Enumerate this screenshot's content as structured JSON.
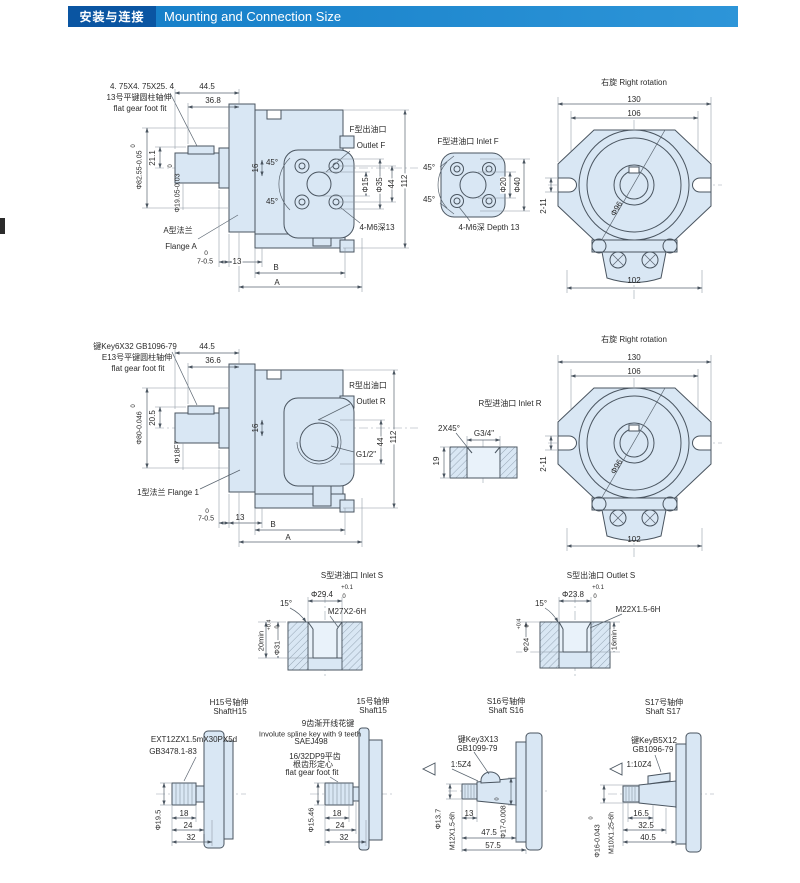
{
  "header": {
    "title_cn": "安装与连接",
    "title_en": "Mounting and Connection Size"
  },
  "colors": {
    "header_box": "#0a55a2",
    "header_bar_from": "#1780c9",
    "header_bar_to": "#2d95d8",
    "draw_fill": "#d9e7f4",
    "line": "#4a5560"
  },
  "labels": [
    {
      "n": "a-key-size",
      "t": "4. 75X4. 75X25. 4",
      "x": 142,
      "y": 87
    },
    {
      "n": "a-key-note-cn",
      "t": "13号平键圆柱轴伸",
      "x": 139,
      "y": 98
    },
    {
      "n": "a-key-note-en",
      "t": "flat gear foot fit",
      "x": 140,
      "y": 109
    },
    {
      "n": "a-dim-44-5",
      "t": "44.5",
      "x": 207,
      "y": 87
    },
    {
      "n": "a-dim-36-8",
      "t": "36.8",
      "x": 213,
      "y": 101
    },
    {
      "n": "a-dim-21-1",
      "t": "21.1",
      "x": 153,
      "y": 158,
      "r": -90
    },
    {
      "n": "a-dim-d82-55",
      "t": "Φ82.55-0.05",
      "x": 140,
      "y": 170,
      "r": -90,
      "s": 7
    },
    {
      "n": "a-dim-d82-55-sup",
      "t": "0",
      "x": 134,
      "y": 146,
      "r": -90,
      "s": 6
    },
    {
      "n": "a-dim-d19-05",
      "t": "Φ19.05-0.03",
      "x": 178,
      "y": 193,
      "r": -90,
      "s": 7
    },
    {
      "n": "a-dim-d19-05-sup",
      "t": "0",
      "x": 171,
      "y": 166,
      "r": -90,
      "s": 6
    },
    {
      "n": "a-dim-16",
      "t": "16",
      "x": 256,
      "y": 168,
      "r": -90
    },
    {
      "n": "a-angle-45-top",
      "t": "45°",
      "x": 272,
      "y": 163
    },
    {
      "n": "a-angle-45-bot",
      "t": "45°",
      "x": 272,
      "y": 202
    },
    {
      "n": "outlet-f-cn",
      "t": "F型出油口",
      "x": 368,
      "y": 130
    },
    {
      "n": "outlet-f-en",
      "t": "Outlet F",
      "x": 371,
      "y": 146
    },
    {
      "n": "a-dim-d15",
      "t": "Φ15",
      "x": 366,
      "y": 185,
      "r": -90,
      "b": 1
    },
    {
      "n": "a-dim-d35",
      "t": "Φ35",
      "x": 380,
      "y": 185,
      "r": -90,
      "b": 1
    },
    {
      "n": "a-dim-44",
      "t": "44",
      "x": 392,
      "y": 184,
      "r": -90,
      "b": 1
    },
    {
      "n": "a-dim-112",
      "t": "112",
      "x": 405,
      "y": 181,
      "r": -90,
      "b": 1
    },
    {
      "n": "a-m6-note",
      "t": "4-M6深13",
      "x": 377,
      "y": 228
    },
    {
      "n": "flange-a-cn",
      "t": "A型法兰",
      "x": 178,
      "y": 231
    },
    {
      "n": "flange-a-en",
      "t": "Flange A",
      "x": 181,
      "y": 247
    },
    {
      "n": "a-dim-7-sup",
      "t": "0",
      "x": 206,
      "y": 254,
      "s": 6.5
    },
    {
      "n": "a-dim-7",
      "t": "7-0.5",
      "x": 205,
      "y": 262,
      "s": 7
    },
    {
      "n": "a-dim-13",
      "t": "13",
      "x": 237,
      "y": 262,
      "b": 1
    },
    {
      "n": "a-dim-b",
      "t": "B",
      "x": 276,
      "y": 268
    },
    {
      "n": "a-dim-a",
      "t": "A",
      "x": 277,
      "y": 283
    },
    {
      "n": "inlet-f-title",
      "t": "F型进油口  Inlet F",
      "x": 468,
      "y": 142
    },
    {
      "n": "f-angle-45-top",
      "t": "45°",
      "x": 429,
      "y": 168
    },
    {
      "n": "f-angle-45-bot",
      "t": "45°",
      "x": 429,
      "y": 200
    },
    {
      "n": "f-dim-d20",
      "t": "Φ20",
      "x": 504,
      "y": 185,
      "r": -90,
      "b": 1
    },
    {
      "n": "f-dim-d40",
      "t": "Φ40",
      "x": 518,
      "y": 185,
      "r": -90,
      "b": 1
    },
    {
      "n": "f-m6-note",
      "t": "4-M6深  Depth 13",
      "x": 489,
      "y": 228
    },
    {
      "n": "rot1-title",
      "t": "右旋  Right rotation",
      "x": 634,
      "y": 83
    },
    {
      "n": "rot1-dim-130",
      "t": "130",
      "x": 634,
      "y": 100
    },
    {
      "n": "rot1-dim-106",
      "t": "106",
      "x": 634,
      "y": 114
    },
    {
      "n": "rot1-dim-2-11",
      "t": "2-11",
      "x": 544,
      "y": 206,
      "r": -90
    },
    {
      "n": "rot1-dim-d96",
      "t": "Φ96",
      "x": 617,
      "y": 209,
      "r": -60
    },
    {
      "n": "rot1-dim-102",
      "t": "102",
      "x": 634,
      "y": 281
    },
    {
      "n": "r-key-note",
      "t": "键Key6X32  GB1096-79",
      "x": 135,
      "y": 347
    },
    {
      "n": "r-key-note-cn",
      "t": "E13号平键圆柱轴伸",
      "x": 137,
      "y": 358
    },
    {
      "n": "r-key-note-en",
      "t": "flat gear foot fit",
      "x": 138,
      "y": 369
    },
    {
      "n": "r-dim-44-5",
      "t": "44.5",
      "x": 207,
      "y": 347
    },
    {
      "n": "r-dim-36-6",
      "t": "36.6",
      "x": 213,
      "y": 361
    },
    {
      "n": "r-dim-20-5",
      "t": "20.5",
      "x": 153,
      "y": 418,
      "r": -90
    },
    {
      "n": "r-dim-d80",
      "t": "Φ80-0.046",
      "x": 140,
      "y": 428,
      "r": -90,
      "s": 7
    },
    {
      "n": "r-dim-d80-sup",
      "t": "0",
      "x": 134,
      "y": 406,
      "r": -90,
      "s": 6
    },
    {
      "n": "r-dim-d18f7",
      "t": "Φ18F7",
      "x": 177,
      "y": 452,
      "r": -90,
      "s": 7.5
    },
    {
      "n": "r-dim-16",
      "t": "16",
      "x": 256,
      "y": 428,
      "r": -90
    },
    {
      "n": "outlet-r-cn",
      "t": "R型出油口",
      "x": 368,
      "y": 386
    },
    {
      "n": "outlet-r-en",
      "t": "Outlet R",
      "x": 371,
      "y": 402
    },
    {
      "n": "r-g12",
      "t": "G1/2\"",
      "x": 366,
      "y": 455
    },
    {
      "n": "r-dim-44",
      "t": "44",
      "x": 381,
      "y": 442,
      "r": -90,
      "b": 1
    },
    {
      "n": "r-dim-112",
      "t": "112",
      "x": 394,
      "y": 437,
      "r": -90,
      "b": 1
    },
    {
      "n": "flange-1",
      "t": "1型法兰  Flange 1",
      "x": 168,
      "y": 493
    },
    {
      "n": "r-dim-7-sup",
      "t": "0",
      "x": 207,
      "y": 512,
      "s": 6.5
    },
    {
      "n": "r-dim-7",
      "t": "7-0.5",
      "x": 206,
      "y": 519,
      "s": 7
    },
    {
      "n": "r-dim-13",
      "t": "13",
      "x": 240,
      "y": 518
    },
    {
      "n": "r-dim-b",
      "t": "B",
      "x": 273,
      "y": 525
    },
    {
      "n": "r-dim-a",
      "t": "A",
      "x": 288,
      "y": 538
    },
    {
      "n": "inlet-r-title",
      "t": "R型进油口  Inlet R",
      "x": 510,
      "y": 404
    },
    {
      "n": "r-2x45",
      "t": "2X45°",
      "x": 449,
      "y": 429
    },
    {
      "n": "r-g34",
      "t": "G3/4\"",
      "x": 484,
      "y": 434
    },
    {
      "n": "r-dim-19",
      "t": "19",
      "x": 437,
      "y": 461,
      "r": -90
    },
    {
      "n": "rot2-title",
      "t": "右旋  Right rotation",
      "x": 634,
      "y": 340
    },
    {
      "n": "rot2-dim-130",
      "t": "130",
      "x": 634,
      "y": 358
    },
    {
      "n": "rot2-dim-106",
      "t": "106",
      "x": 634,
      "y": 372
    },
    {
      "n": "rot2-dim-2-11",
      "t": "2-11",
      "x": 544,
      "y": 464,
      "r": -90
    },
    {
      "n": "rot2-dim-d96",
      "t": "Φ96",
      "x": 617,
      "y": 467,
      "r": -60
    },
    {
      "n": "rot2-dim-102",
      "t": "102",
      "x": 634,
      "y": 540
    },
    {
      "n": "inlet-s-title",
      "t": "S型进油口  Inlet S",
      "x": 352,
      "y": 576
    },
    {
      "n": "s-dim-d29-4",
      "t": "Φ29.4",
      "x": 322,
      "y": 595
    },
    {
      "n": "s-dim-d29-4-sup",
      "t": "+0.1",
      "x": 347,
      "y": 588,
      "s": 6
    },
    {
      "n": "s-dim-d29-4-sub",
      "t": "0",
      "x": 344,
      "y": 597,
      "s": 6
    },
    {
      "n": "s-angle-15",
      "t": "15°",
      "x": 286,
      "y": 604
    },
    {
      "n": "s-thread-m27",
      "t": "M27X2-6H",
      "x": 347,
      "y": 612
    },
    {
      "n": "s-dim-20min",
      "t": "20min",
      "x": 261,
      "y": 641,
      "r": -90,
      "s": 7.5
    },
    {
      "n": "s-dim-d31",
      "t": "Φ31",
      "x": 277,
      "y": 648,
      "r": -90,
      "s": 7.5,
      "b": 1
    },
    {
      "n": "s-dim-d31-sup",
      "t": "+0.4",
      "x": 270,
      "y": 625,
      "r": -90,
      "s": 5.5
    },
    {
      "n": "s-dim-d31-sub",
      "t": "0",
      "x": 278,
      "y": 627,
      "r": -90,
      "s": 5.5
    },
    {
      "n": "outlet-s-title",
      "t": "S型出油口  Outlet S",
      "x": 601,
      "y": 576
    },
    {
      "n": "s-dim-d23-8",
      "t": "Φ23.8",
      "x": 573,
      "y": 595
    },
    {
      "n": "s-dim-d23-8-sup",
      "t": "+0.1",
      "x": 598,
      "y": 588,
      "s": 6
    },
    {
      "n": "s-dim-d23-8-sub",
      "t": "0",
      "x": 595,
      "y": 597,
      "s": 6
    },
    {
      "n": "so-angle-15",
      "t": "15°",
      "x": 541,
      "y": 604
    },
    {
      "n": "s-thread-m22",
      "t": "M22X1.5-6H",
      "x": 638,
      "y": 610
    },
    {
      "n": "s-dim-d24",
      "t": "Φ24",
      "x": 526,
      "y": 645,
      "r": -90,
      "s": 7.5,
      "b": 1
    },
    {
      "n": "s-dim-d24-sup",
      "t": "+0.4",
      "x": 520,
      "y": 624,
      "r": -90,
      "s": 5.5
    },
    {
      "n": "s-dim-d24-sub",
      "t": "0",
      "x": 528,
      "y": 626,
      "r": -90,
      "s": 5.5
    },
    {
      "n": "s-dim-16min",
      "t": "16min",
      "x": 614,
      "y": 640,
      "r": -90,
      "s": 7.5,
      "b": 1
    },
    {
      "n": "sh1-title-cn",
      "t": "H15号轴伸",
      "x": 229,
      "y": 703
    },
    {
      "n": "sh1-title-en",
      "t": "ShaftH15",
      "x": 230,
      "y": 712
    },
    {
      "n": "sh1-spline-note",
      "t": "EXT12ZX1.5mX30PX5d",
      "x": 194,
      "y": 740
    },
    {
      "n": "sh1-std",
      "t": "GB3478.1-83",
      "x": 173,
      "y": 752
    },
    {
      "n": "sh1-dim-d19-5",
      "t": "Φ19.5",
      "x": 158,
      "y": 820,
      "r": -90,
      "s": 7.5
    },
    {
      "n": "sh1-dim-18",
      "t": "18",
      "x": 184,
      "y": 814
    },
    {
      "n": "sh1-dim-24",
      "t": "24",
      "x": 188,
      "y": 826
    },
    {
      "n": "sh1-dim-32",
      "t": "32",
      "x": 191,
      "y": 838
    },
    {
      "n": "sh2-title-cn",
      "t": "15号轴伸",
      "x": 373,
      "y": 702
    },
    {
      "n": "sh2-title-en",
      "t": "Shaft15",
      "x": 373,
      "y": 711
    },
    {
      "n": "sh2-spline-cn",
      "t": "9齿渐开线花键",
      "x": 328,
      "y": 724
    },
    {
      "n": "sh2-spline-en",
      "t": "Involute spline key with 9 teeth",
      "x": 310,
      "y": 734,
      "s": 7.5
    },
    {
      "n": "sh2-sae",
      "t": "SAEJ498",
      "x": 311,
      "y": 742
    },
    {
      "n": "sh2-dp-note",
      "t": "16/32DP9平齿",
      "x": 315,
      "y": 757
    },
    {
      "n": "sh2-root-note",
      "t": "根齿形定心",
      "x": 313,
      "y": 765
    },
    {
      "n": "sh2-fit-note",
      "t": "flat gear foot fit",
      "x": 312,
      "y": 773
    },
    {
      "n": "sh2-dim-d15-46",
      "t": "Φ15.46",
      "x": 311,
      "y": 820,
      "r": -90,
      "s": 7.5
    },
    {
      "n": "sh2-dim-18",
      "t": "18",
      "x": 337,
      "y": 814
    },
    {
      "n": "sh2-dim-24",
      "t": "24",
      "x": 340,
      "y": 826
    },
    {
      "n": "sh2-dim-32",
      "t": "32",
      "x": 344,
      "y": 838
    },
    {
      "n": "sh3-title-cn",
      "t": "S16号轴伸",
      "x": 506,
      "y": 702
    },
    {
      "n": "sh3-title-en",
      "t": "Shaft S16",
      "x": 506,
      "y": 711
    },
    {
      "n": "sh3-key-note",
      "t": "键Key3X13",
      "x": 478,
      "y": 740
    },
    {
      "n": "sh3-std",
      "t": "GB1099-79",
      "x": 477,
      "y": 749
    },
    {
      "n": "sh3-taper",
      "t": "1:5Z4",
      "x": 461,
      "y": 765
    },
    {
      "n": "sh3-dim-d13-7",
      "t": "Φ13.7",
      "x": 438,
      "y": 819,
      "r": -90,
      "s": 7.5
    },
    {
      "n": "sh3-thread-m12",
      "t": "M12X1.5-6h",
      "x": 453,
      "y": 831,
      "r": -90,
      "s": 7
    },
    {
      "n": "sh3-dim-13",
      "t": "13",
      "x": 469,
      "y": 814
    },
    {
      "n": "sh3-dim-d17",
      "t": "Φ17-0.008",
      "x": 504,
      "y": 822,
      "r": -90,
      "s": 7
    },
    {
      "n": "sh3-dim-d17-sup",
      "t": "0",
      "x": 498,
      "y": 799,
      "r": -90,
      "s": 5.5
    },
    {
      "n": "sh3-dim-47-5",
      "t": "47.5",
      "x": 489,
      "y": 833
    },
    {
      "n": "sh3-dim-57-5",
      "t": "57.5",
      "x": 493,
      "y": 846
    },
    {
      "n": "sh4-title-cn",
      "t": "S17号轴伸",
      "x": 664,
      "y": 703
    },
    {
      "n": "sh4-title-en",
      "t": "Shaft S17",
      "x": 663,
      "y": 712
    },
    {
      "n": "sh4-key-note",
      "t": "键KeyB5X12",
      "x": 654,
      "y": 741
    },
    {
      "n": "sh4-std",
      "t": "GB1096-79",
      "x": 653,
      "y": 750
    },
    {
      "n": "sh4-taper",
      "t": "1:10Z4",
      "x": 639,
      "y": 765
    },
    {
      "n": "sh4-dim-d16",
      "t": "Φ16-0.043",
      "x": 598,
      "y": 841,
      "r": -90,
      "s": 7
    },
    {
      "n": "sh4-dim-d16-sup",
      "t": "0",
      "x": 592,
      "y": 818,
      "r": -90,
      "s": 5.5
    },
    {
      "n": "sh4-thread-m10",
      "t": "M10X1.25-6h",
      "x": 612,
      "y": 833,
      "r": -90,
      "s": 7
    },
    {
      "n": "sh4-dim-16-5",
      "t": "16.5",
      "x": 641,
      "y": 814
    },
    {
      "n": "sh4-dim-32-5",
      "t": "32.5",
      "x": 646,
      "y": 826
    },
    {
      "n": "sh4-dim-40-5",
      "t": "40.5",
      "x": 648,
      "y": 838
    }
  ]
}
